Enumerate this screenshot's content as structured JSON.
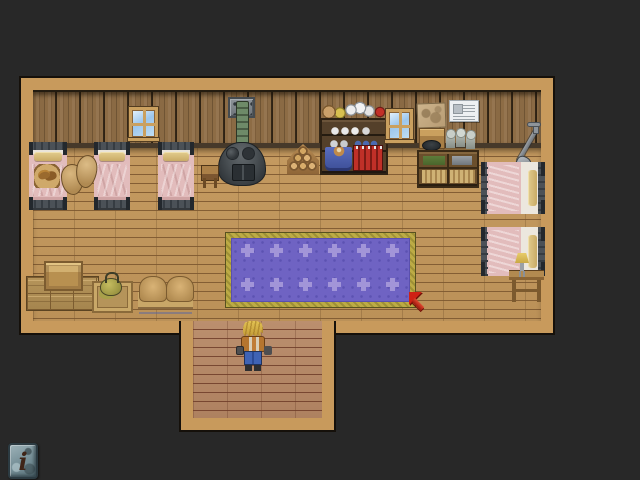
{
  "app": {
    "type": "top-down rpg interior scene",
    "view": "bunkhouse room with hallway"
  },
  "hud": {
    "info_button": {
      "glyph": "i",
      "shape": "stone tablet"
    }
  },
  "room": {
    "main": {
      "x": 21,
      "y": 78,
      "w": 532,
      "h": 255
    },
    "hall": {
      "x": 181,
      "y": 321,
      "w": 153,
      "h": 109
    }
  },
  "player": {
    "facing": "up",
    "hair": "blond",
    "vest_color": "#c07c36",
    "pants_color": "#3f63b5"
  },
  "cursor": {
    "style": "red arrow",
    "direction": "up-left",
    "meaning": "move target marker"
  },
  "palette": {
    "background": "#282828",
    "frame": "#c89a5c",
    "wall": "#8d6c45",
    "floor": "#c0975d",
    "hall_floor": "#b98a6b",
    "carpet_field": "#6f63c3",
    "carpet_border": "#b3a23f",
    "carpet_motif": "#a295d8",
    "bed_blanket": "#e2bcbc",
    "pillow": "#d8c080",
    "stove_body": "#43494d",
    "stove_pipe": "#5f7a5a",
    "cursor_red": "#cf2114"
  },
  "carpet_pattern": {
    "rows": 2,
    "cols": 6,
    "x0": 10,
    "y0": 6,
    "dx": 29,
    "dy": 34,
    "size": 13
  },
  "scene": {
    "objects": [
      {
        "type": "window",
        "name": "window-left",
        "x": 129,
        "y": 107,
        "w": 29,
        "h": 33,
        "interactable": false
      },
      {
        "type": "stove",
        "name": "iron-stove",
        "x": 218,
        "y": 96,
        "w": 48,
        "h": 90,
        "interactable": true
      },
      {
        "type": "firewood",
        "name": "firewood-pile",
        "x": 287,
        "y": 144,
        "w": 32,
        "h": 30,
        "interactable": true
      },
      {
        "type": "hutch",
        "name": "kitchen-hutch",
        "x": 319,
        "y": 99,
        "w": 70,
        "h": 76,
        "interactable": true
      },
      {
        "type": "window",
        "name": "window-right",
        "x": 386,
        "y": 109,
        "w": 27,
        "h": 33,
        "interactable": false
      },
      {
        "type": "map-paper",
        "name": "wall-map",
        "x": 417,
        "y": 103,
        "w": 29,
        "h": 25,
        "interactable": true
      },
      {
        "type": "notice",
        "name": "wall-notice",
        "x": 449,
        "y": 100,
        "w": 30,
        "h": 22,
        "interactable": true
      },
      {
        "type": "workbench",
        "name": "workbench",
        "x": 417,
        "y": 126,
        "w": 62,
        "h": 62,
        "interactable": true
      },
      {
        "type": "shovel",
        "name": "shovel",
        "x": 514,
        "y": 122,
        "w": 28,
        "h": 54,
        "interactable": true
      },
      {
        "type": "bed-v",
        "name": "bed-left-1",
        "x": 29,
        "y": 142,
        "w": 38,
        "h": 68,
        "interactable": true
      },
      {
        "type": "bed-v",
        "name": "bed-left-2",
        "x": 94,
        "y": 142,
        "w": 36,
        "h": 68,
        "interactable": true
      },
      {
        "type": "bed-v",
        "name": "bed-left-3",
        "x": 158,
        "y": 142,
        "w": 36,
        "h": 68,
        "interactable": true
      },
      {
        "type": "basket",
        "name": "bread-basket",
        "x": 34,
        "y": 164,
        "w": 26,
        "h": 24,
        "interactable": true
      },
      {
        "type": "sacks",
        "name": "grain-sacks",
        "x": 61,
        "y": 155,
        "w": 36,
        "h": 40,
        "interactable": true
      },
      {
        "type": "stool",
        "name": "stool",
        "x": 201,
        "y": 165,
        "w": 18,
        "h": 23,
        "interactable": true
      },
      {
        "type": "bed-h",
        "name": "bed-right-1",
        "x": 481,
        "y": 162,
        "w": 64,
        "h": 52,
        "interactable": true
      },
      {
        "type": "bed-h",
        "name": "bed-right-2",
        "x": 481,
        "y": 227,
        "w": 64,
        "h": 49,
        "interactable": true
      },
      {
        "type": "carpet",
        "name": "purple-carpet",
        "x": 226,
        "y": 233,
        "w": 189,
        "h": 74,
        "interactable": true
      },
      {
        "type": "nightstand",
        "name": "nightstand-lamp",
        "x": 509,
        "y": 253,
        "w": 35,
        "h": 50,
        "interactable": true
      },
      {
        "type": "crates",
        "name": "crate-stack",
        "x": 26,
        "y": 261,
        "w": 71,
        "h": 48,
        "interactable": true
      },
      {
        "type": "teapot-crate",
        "name": "teapot-crate",
        "x": 92,
        "y": 272,
        "w": 37,
        "h": 37,
        "interactable": true
      },
      {
        "type": "sofa",
        "name": "wicker-sofa",
        "x": 138,
        "y": 276,
        "w": 55,
        "h": 36,
        "interactable": true
      },
      {
        "type": "player",
        "name": "player-character",
        "x": 236,
        "y": 320,
        "w": 34,
        "h": 52,
        "interactable": true
      },
      {
        "type": "cursor",
        "name": "move-target-cursor",
        "x": 409,
        "y": 292,
        "w": 24,
        "h": 24,
        "interactable": false
      }
    ]
  }
}
